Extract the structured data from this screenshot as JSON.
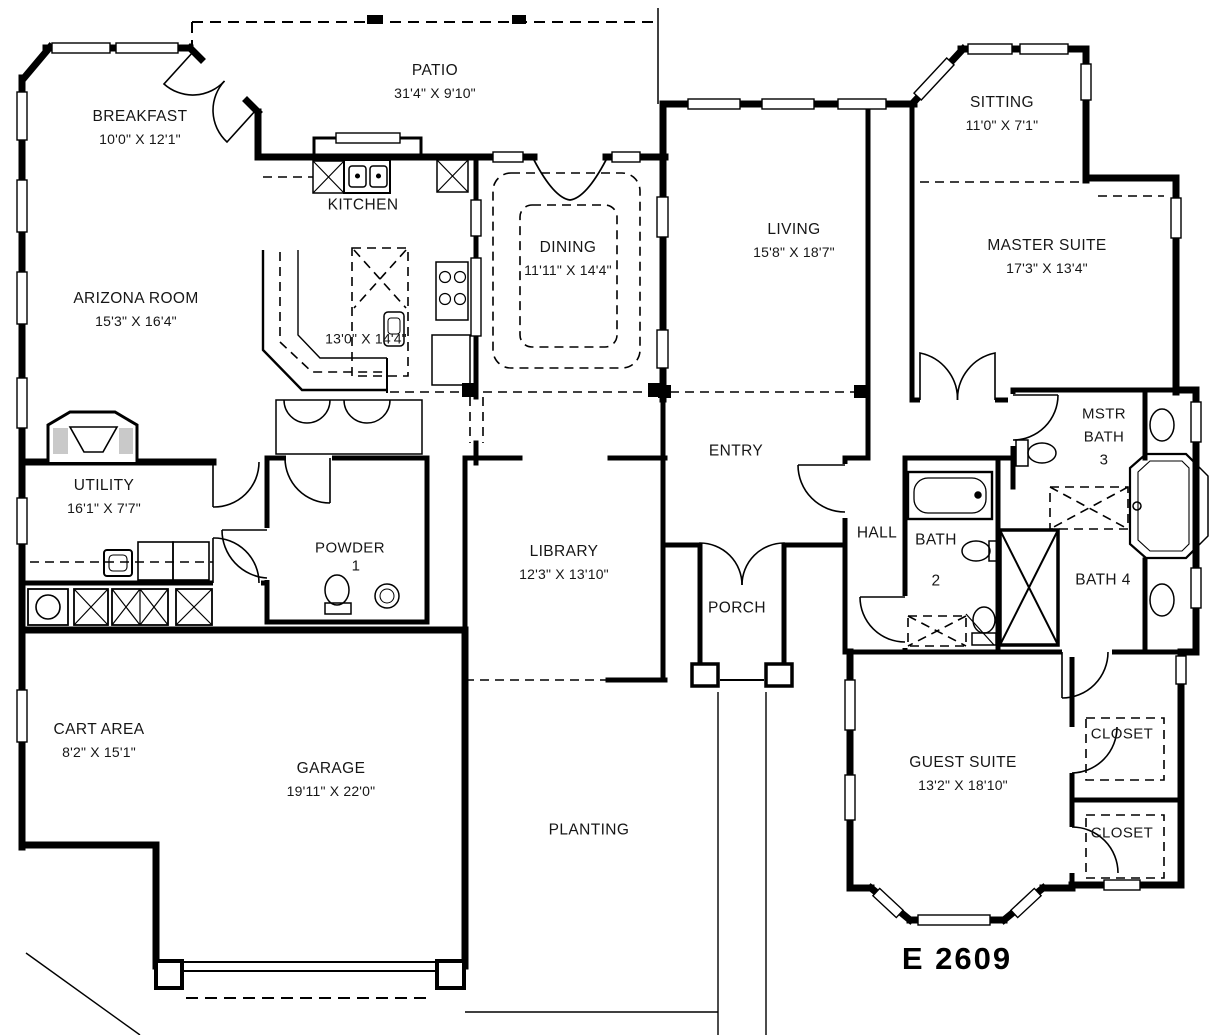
{
  "plan_number": "E 2609",
  "rooms": {
    "breakfast": {
      "name": "BREAKFAST",
      "dims": "10'0\" X 12'1\""
    },
    "patio": {
      "name": "PATIO",
      "dims": "31'4\" X 9'10\""
    },
    "kitchen": {
      "name": "KITCHEN",
      "dims": "13'0\" X 14'4\""
    },
    "arizona_room": {
      "name": "ARIZONA ROOM",
      "dims": "15'3\" X 16'4\""
    },
    "dining": {
      "name": "DINING",
      "dims": "11'11\" X 14'4\""
    },
    "living": {
      "name": "LIVING",
      "dims": "15'8\" X 18'7\""
    },
    "sitting": {
      "name": "SITTING",
      "dims": "11'0\" X 7'1\""
    },
    "master_suite": {
      "name": "MASTER SUITE",
      "dims": "17'3\" X 13'4\""
    },
    "utility": {
      "name": "UTILITY",
      "dims": "16'1\" X 7'7\""
    },
    "powder": {
      "name": "POWDER",
      "number": "1"
    },
    "library": {
      "name": "LIBRARY",
      "dims": "12'3\" X 13'10\""
    },
    "entry": {
      "name": "ENTRY"
    },
    "hall": {
      "name": "HALL"
    },
    "bath_2": {
      "name": "BATH",
      "number": "2"
    },
    "mstr_bath": {
      "line1": "MSTR",
      "line2": "BATH",
      "number": "3"
    },
    "bath_4": {
      "name": "BATH 4"
    },
    "porch": {
      "name": "PORCH"
    },
    "cart_area": {
      "name": "CART AREA",
      "dims": "8'2\" X 15'1\""
    },
    "garage": {
      "name": "GARAGE",
      "dims": "19'11\" X 22'0\""
    },
    "guest_suite": {
      "name": "GUEST SUITE",
      "dims": "13'2\" X 18'10\""
    },
    "closet_guest_upper": {
      "name": "CLOSET"
    },
    "closet_guest_lower": {
      "name": "CLOSET"
    },
    "planting": {
      "name": "PLANTING"
    }
  }
}
